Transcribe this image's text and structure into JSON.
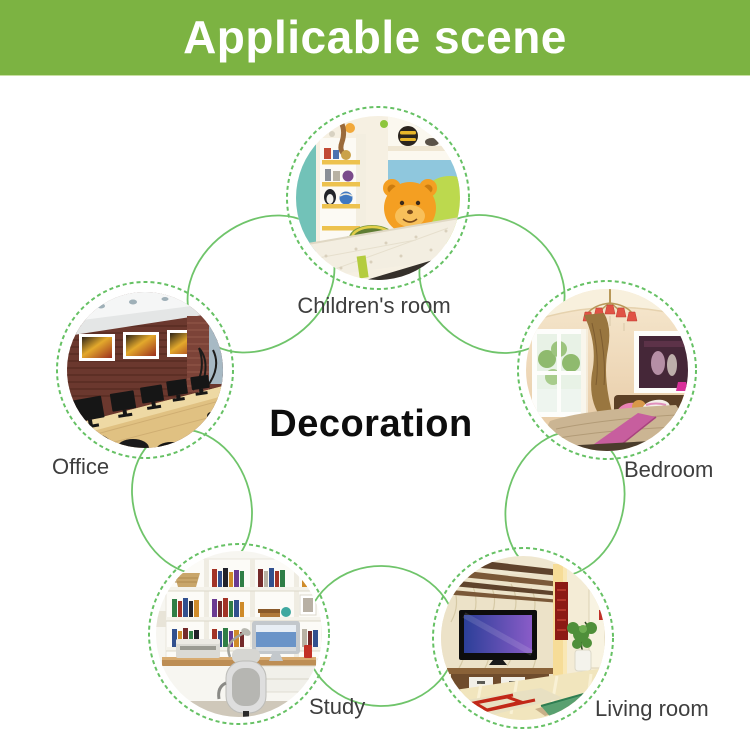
{
  "header": {
    "title": "Applicable scene"
  },
  "diagram": {
    "center_title": "Decoration",
    "scenes": [
      {
        "label": "Children's room"
      },
      {
        "label": "Office"
      },
      {
        "label": "Bedroom"
      },
      {
        "label": "Study"
      },
      {
        "label": "Living room"
      }
    ]
  },
  "colors": {
    "banner_green": "#7CB342",
    "line_green": "#66C164",
    "banner_text": "#FFFFFF",
    "center_title_text": "#0D0D0D",
    "label_text": "#3E3E3E"
  }
}
